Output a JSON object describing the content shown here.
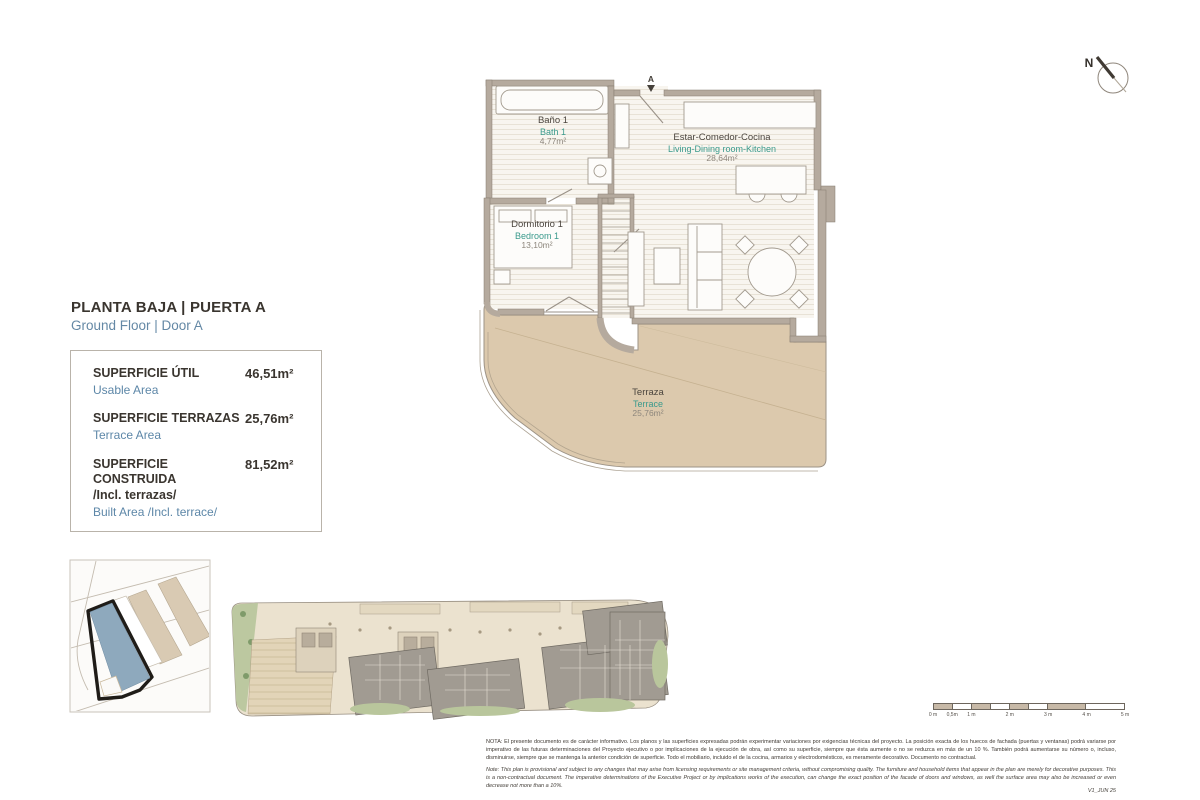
{
  "document": {
    "title_es": "PLANTA BAJA | PUERTA A",
    "title_en": "Ground Floor | Door A",
    "version": "V1_JUN 25"
  },
  "surface_box": {
    "items": [
      {
        "label_es": "SUPERFICIE ÚTIL",
        "label_es_extra": "",
        "label_en": "Usable Area",
        "value": "46,51m²"
      },
      {
        "label_es": "SUPERFICIE TERRAZAS",
        "label_es_extra": "",
        "label_en": "Terrace Area",
        "value": "25,76m²"
      },
      {
        "label_es": "SUPERFICIE CONSTRUIDA",
        "label_es_extra": "/Incl. terrazas/",
        "label_en": "Built Area /Incl. terrace/",
        "value": "81,52m²"
      }
    ]
  },
  "floor_plan": {
    "north_label": "N",
    "entrance_label": "A",
    "rooms": [
      {
        "name_es": "Baño 1",
        "name_en": "Bath 1",
        "area": "4,77m²"
      },
      {
        "name_es": "Estar-Comedor-Cocina",
        "name_en": "Living-Dining room-Kitchen",
        "area": "28,64m²"
      },
      {
        "name_es": "Dormitorio 1",
        "name_en": "Bedroom 1",
        "area": "13,10m²"
      },
      {
        "name_es": "Terraza",
        "name_en": "Terrace",
        "area": "25,76m²"
      }
    ]
  },
  "scale_bar": {
    "labels": [
      "0 m",
      "0,5m",
      "1 m",
      "2 m",
      "3 m",
      "4 m",
      "5 m"
    ]
  },
  "notes": {
    "es": "NOTA: El presente documento es de carácter informativo. Los planos y las superficies expresadas podrán experimentar variaciones por exigencias técnicas del proyecto. La posición exacta de los huecos de fachada (puertas y ventanas) podrá variarse por imperativo de las futuras determinaciones del Proyecto ejecutivo o por implicaciones de la ejecución de obra, así como su superficie, siempre que ésta aumente o no se reduzca en más de un 10 %. También podrá aumentarse su número o, incluso, disminuirse, siempre que se mantenga la anterior condición de superficie. Todo el mobiliario, incluido el de la cocina, armarios y electrodomésticos, es meramente decorativo. Documento no contractual.",
    "en": "Note: This plan is provisional and subject to any changes that may arise from licensing requirements or site management criteria, without compromising quality. The furniture and household items that appear in the plan are merely for decorative purposes. This is a non-contractual document. The imperative determinations of the Executive Project or by implications works of the execution, can change the exact position of the facade of doors and windows, as well the surface area may also be increased or even decrease not more than a 10%."
  },
  "colors": {
    "accent_blue": "#6488a5",
    "accent_teal": "#3a9a8c",
    "wall": "#b5aa9e",
    "terrace_fill": "#dcc9ad",
    "highlight_building": "#8ea9bd"
  }
}
